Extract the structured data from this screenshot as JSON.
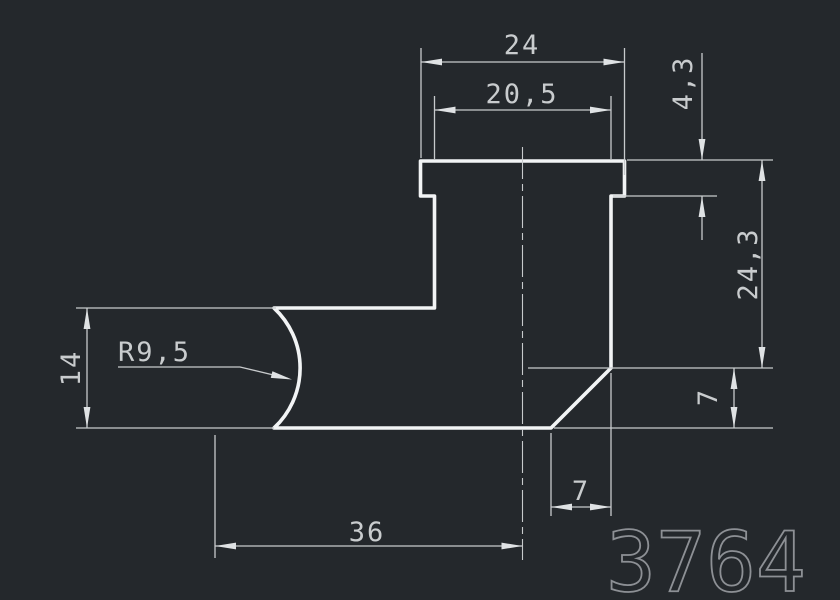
{
  "app": {
    "background_color": "#24282c",
    "outline_color": "#f2f4f5",
    "dimension_color": "#c7cacc",
    "number_color": "#8d9095"
  },
  "drawing": {
    "number": "3764",
    "dimensions": {
      "outer_width": {
        "label": "24",
        "value": 24,
        "orientation": "horizontal"
      },
      "inner_width": {
        "label": "20,5",
        "value": 20.5,
        "orientation": "horizontal"
      },
      "lip_depth": {
        "label": "4,3",
        "value": 4.3,
        "orientation": "vertical"
      },
      "right_height": {
        "label": "24,3",
        "value": 24.3,
        "orientation": "vertical"
      },
      "chamfer_height": {
        "label": "7",
        "value": 7,
        "orientation": "vertical"
      },
      "chamfer_width": {
        "label": "7",
        "value": 7,
        "orientation": "horizontal"
      },
      "left_height": {
        "label": "14",
        "value": 14,
        "orientation": "vertical"
      },
      "corner_radius": {
        "label": "R9,5",
        "value": 9.5,
        "orientation": "leader"
      },
      "base_length": {
        "label": "36",
        "value": 36,
        "orientation": "horizontal"
      }
    }
  }
}
